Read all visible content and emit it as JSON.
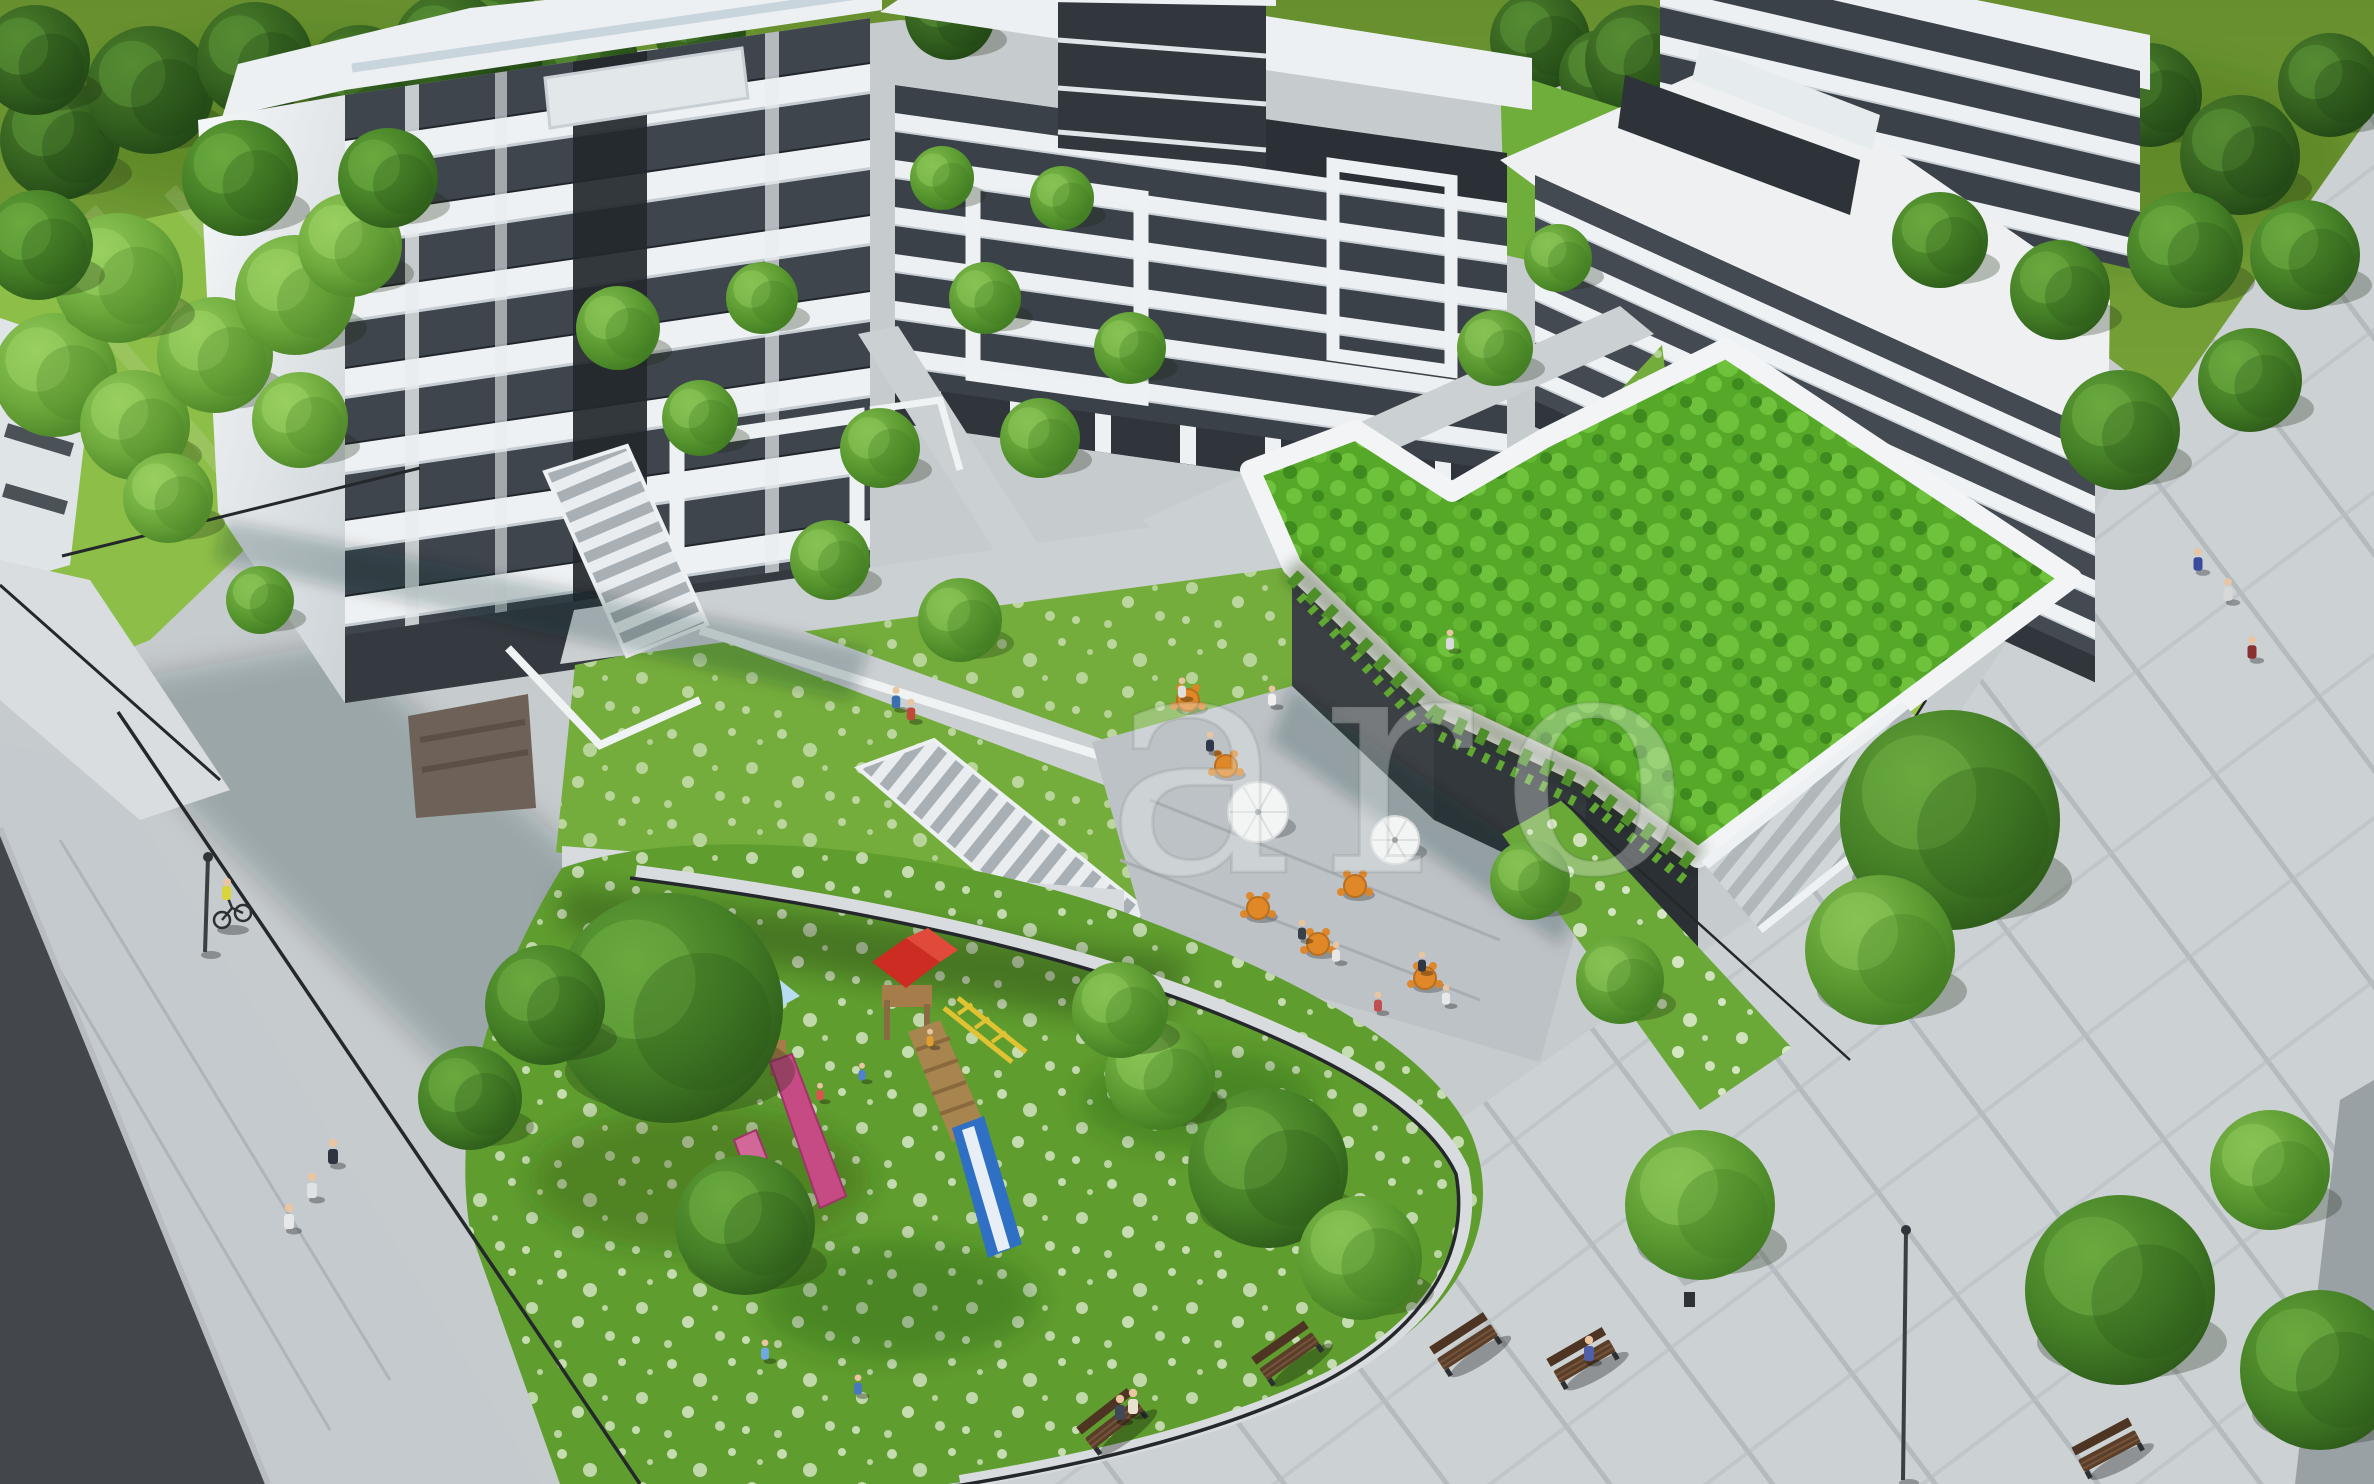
{
  "scene_type": "aerial-architectural-render",
  "watermark": {
    "text": "aro"
  },
  "palette": {
    "meadow": "#6f9b33",
    "lawn_bright": "#8cbe48",
    "courtyard_grass": "#74ad3c",
    "garden_grass": "#5f9e2e",
    "roof_garden": "#55a828",
    "flower_white": "#eef4e4",
    "pavement_light": "#ccd1d4",
    "pavement_mid": "#c4cace",
    "asphalt": "#43474c",
    "building_white": "#eef1f3",
    "glazing_dark": "#3e454d",
    "wall_charcoal": "#33383c",
    "furniture_orange": "#e08828",
    "bench_wood": "#5b3e29",
    "slide_pink": "#c64a84",
    "slide_blue": "#2f6fc4",
    "roof_red": "#cc2c22",
    "roof_light_blue": "#8fc4e6",
    "bars_yellow": "#e0c232"
  },
  "objects": {
    "trees": [
      {
        "x": 500,
        "y": 40,
        "r": 52,
        "t": "dark",
        "back": true
      },
      {
        "x": 590,
        "y": 60,
        "r": 48,
        "t": "dark",
        "back": true
      },
      {
        "x": 700,
        "y": 30,
        "r": 46,
        "t": "dark",
        "back": true
      },
      {
        "x": 950,
        "y": 15,
        "r": 45,
        "t": "dark",
        "back": true
      },
      {
        "x": 1540,
        "y": 40,
        "r": 50,
        "t": "dark",
        "back": true
      },
      {
        "x": 1605,
        "y": 75,
        "r": 46,
        "t": "dark",
        "back": true
      },
      {
        "x": 1640,
        "y": 60,
        "r": 55,
        "t": "dark",
        "back": true
      },
      {
        "x": 1730,
        "y": 110,
        "r": 50,
        "t": "dark",
        "back": true
      },
      {
        "x": 1810,
        "y": 55,
        "r": 52,
        "t": "dark",
        "back": true
      },
      {
        "x": 1900,
        "y": 130,
        "r": 55,
        "t": "dark",
        "back": true
      },
      {
        "x": 1990,
        "y": 75,
        "r": 50,
        "t": "dark",
        "back": true
      },
      {
        "x": 2070,
        "y": 160,
        "r": 55,
        "t": "dark",
        "back": true
      },
      {
        "x": 2150,
        "y": 95,
        "r": 52,
        "t": "dark",
        "back": true
      },
      {
        "x": 2240,
        "y": 155,
        "r": 60,
        "t": "dark",
        "back": true
      },
      {
        "x": 2330,
        "y": 85,
        "r": 52,
        "t": "dark",
        "back": true
      },
      {
        "x": 60,
        "y": 140,
        "r": 60,
        "t": "dark",
        "back": true
      },
      {
        "x": 150,
        "y": 90,
        "r": 64,
        "t": "dark",
        "back": true
      },
      {
        "x": 255,
        "y": 60,
        "r": 58,
        "t": "dark",
        "back": true
      },
      {
        "x": 360,
        "y": 80,
        "r": 55,
        "t": "dark",
        "back": true
      },
      {
        "x": 450,
        "y": 50,
        "r": 58,
        "t": "dark",
        "back": true
      },
      {
        "x": 35,
        "y": 60,
        "r": 55,
        "t": "dark",
        "back": true
      },
      {
        "x": 55,
        "y": 375,
        "r": 62,
        "t": "birch"
      },
      {
        "x": 135,
        "y": 425,
        "r": 55,
        "t": "birch"
      },
      {
        "x": 215,
        "y": 355,
        "r": 58,
        "t": "birch"
      },
      {
        "x": 295,
        "y": 295,
        "r": 60,
        "t": "birch"
      },
      {
        "x": 118,
        "y": 278,
        "r": 65,
        "t": "birch"
      },
      {
        "x": 38,
        "y": 245,
        "r": 55,
        "t": "mid"
      },
      {
        "x": 350,
        "y": 245,
        "r": 52,
        "t": "birch"
      },
      {
        "x": 300,
        "y": 420,
        "r": 48,
        "t": "birch"
      },
      {
        "x": 168,
        "y": 498,
        "r": 45,
        "t": "birch"
      },
      {
        "x": 388,
        "y": 178,
        "r": 50,
        "t": "mid"
      },
      {
        "x": 240,
        "y": 178,
        "r": 58,
        "t": "mid"
      },
      {
        "x": 2305,
        "y": 255,
        "r": 55,
        "t": "mid"
      },
      {
        "x": 2185,
        "y": 250,
        "r": 58,
        "t": "mid"
      },
      {
        "x": 2060,
        "y": 290,
        "r": 50,
        "t": "mid"
      },
      {
        "x": 1940,
        "y": 240,
        "r": 48,
        "t": "mid"
      },
      {
        "x": 2120,
        "y": 430,
        "r": 60,
        "t": "mid"
      },
      {
        "x": 2250,
        "y": 380,
        "r": 52,
        "t": "mid"
      },
      {
        "x": 1950,
        "y": 820,
        "r": 110,
        "t": "mid"
      },
      {
        "x": 1880,
        "y": 950,
        "r": 75,
        "t": "light"
      },
      {
        "x": 2120,
        "y": 1290,
        "r": 95,
        "t": "mid"
      },
      {
        "x": 2320,
        "y": 1370,
        "r": 80,
        "t": "mid"
      },
      {
        "x": 2270,
        "y": 1170,
        "r": 60,
        "t": "light"
      },
      {
        "x": 1700,
        "y": 1205,
        "r": 75,
        "t": "light"
      },
      {
        "x": 618,
        "y": 328,
        "r": 42,
        "t": "light"
      },
      {
        "x": 700,
        "y": 418,
        "r": 38,
        "t": "light"
      },
      {
        "x": 762,
        "y": 298,
        "r": 36,
        "t": "light"
      },
      {
        "x": 880,
        "y": 448,
        "r": 40,
        "t": "light"
      },
      {
        "x": 985,
        "y": 298,
        "r": 36,
        "t": "light"
      },
      {
        "x": 1040,
        "y": 438,
        "r": 40,
        "t": "light"
      },
      {
        "x": 1130,
        "y": 348,
        "r": 36,
        "t": "light"
      },
      {
        "x": 942,
        "y": 178,
        "r": 32,
        "t": "light"
      },
      {
        "x": 1062,
        "y": 198,
        "r": 32,
        "t": "light"
      },
      {
        "x": 1495,
        "y": 348,
        "r": 38,
        "t": "light"
      },
      {
        "x": 1558,
        "y": 258,
        "r": 34,
        "t": "light"
      },
      {
        "x": 830,
        "y": 560,
        "r": 40,
        "t": "light"
      },
      {
        "x": 960,
        "y": 620,
        "r": 42,
        "t": "light"
      },
      {
        "x": 260,
        "y": 600,
        "r": 34,
        "t": "light"
      },
      {
        "x": 668,
        "y": 1008,
        "r": 115,
        "t": "mid"
      },
      {
        "x": 745,
        "y": 1225,
        "r": 70,
        "t": "mid"
      },
      {
        "x": 545,
        "y": 1005,
        "r": 60,
        "t": "mid"
      },
      {
        "x": 470,
        "y": 1098,
        "r": 52,
        "t": "mid"
      },
      {
        "x": 1268,
        "y": 1168,
        "r": 80,
        "t": "mid"
      },
      {
        "x": 1360,
        "y": 1258,
        "r": 62,
        "t": "light"
      },
      {
        "x": 1160,
        "y": 1075,
        "r": 55,
        "t": "light"
      },
      {
        "x": 1120,
        "y": 1010,
        "r": 48,
        "t": "light"
      },
      {
        "x": 1530,
        "y": 880,
        "r": 40,
        "t": "light"
      },
      {
        "x": 1620,
        "y": 980,
        "r": 44,
        "t": "light"
      }
    ],
    "people": [
      {
        "x": 289,
        "y": 1217,
        "s": 1,
        "c": "#e8e8e8"
      },
      {
        "x": 312,
        "y": 1186,
        "s": 1,
        "c": "#dfe3e6"
      },
      {
        "x": 333,
        "y": 1152,
        "s": 1,
        "c": "#2e3340"
      },
      {
        "x": 896,
        "y": 698,
        "s": 0.85,
        "c": "#3a6fb0"
      },
      {
        "x": 911,
        "y": 710,
        "s": 0.85,
        "c": "#c04a3a"
      },
      {
        "x": 2198,
        "y": 560,
        "s": 0.9,
        "c": "#3a4a9c"
      },
      {
        "x": 2228,
        "y": 590,
        "s": 0.9,
        "c": "#d8d8d8"
      },
      {
        "x": 2252,
        "y": 648,
        "s": 0.9,
        "c": "#8a3030"
      },
      {
        "x": 1182,
        "y": 688,
        "s": 0.8,
        "c": "#e0e0e0"
      },
      {
        "x": 1210,
        "y": 742,
        "s": 0.8,
        "c": "#30384a"
      },
      {
        "x": 1272,
        "y": 696,
        "s": 0.8,
        "c": "#f0f0f0"
      },
      {
        "x": 1302,
        "y": 930,
        "s": 0.8,
        "c": "#384048"
      },
      {
        "x": 1336,
        "y": 952,
        "s": 0.8,
        "c": "#e8e8e8"
      },
      {
        "x": 1422,
        "y": 962,
        "s": 0.8,
        "c": "#303848"
      },
      {
        "x": 1446,
        "y": 995,
        "s": 0.8,
        "c": "#e8e8e8"
      },
      {
        "x": 1378,
        "y": 1002,
        "s": 0.8,
        "c": "#c05050"
      },
      {
        "x": 1120,
        "y": 1408,
        "s": 1,
        "c": "#404858"
      },
      {
        "x": 1133,
        "y": 1402,
        "s": 1,
        "c": "#e8e0d0"
      },
      {
        "x": 1589,
        "y": 1349,
        "s": 1,
        "c": "#5060a8"
      },
      {
        "x": 820,
        "y": 1092,
        "s": 0.7,
        "c": "#e05050"
      },
      {
        "x": 862,
        "y": 1072,
        "s": 0.7,
        "c": "#5080d0"
      },
      {
        "x": 930,
        "y": 1038,
        "s": 0.7,
        "c": "#e0a030"
      },
      {
        "x": 765,
        "y": 1350,
        "s": 0.8,
        "c": "#70a8e0"
      },
      {
        "x": 858,
        "y": 1385,
        "s": 0.8,
        "c": "#4878c0"
      },
      {
        "x": 1450,
        "y": 640,
        "s": 0.8,
        "c": "#d8dadc"
      }
    ],
    "cafe_tables": [
      {
        "x": 1188,
        "y": 700
      },
      {
        "x": 1226,
        "y": 766
      },
      {
        "x": 1258,
        "y": 908
      },
      {
        "x": 1318,
        "y": 944
      },
      {
        "x": 1355,
        "y": 886
      },
      {
        "x": 1425,
        "y": 978
      }
    ],
    "umbrellas": [
      {
        "x": 1258,
        "y": 812,
        "r": 30
      },
      {
        "x": 1395,
        "y": 840,
        "r": 24
      }
    ],
    "benches": [
      {
        "x": 1115,
        "y": 1425,
        "rot": -38
      },
      {
        "x": 1290,
        "y": 1357,
        "rot": -35
      },
      {
        "x": 1468,
        "y": 1348,
        "rot": -33
      },
      {
        "x": 1585,
        "y": 1362,
        "rot": -30
      },
      {
        "x": 2110,
        "y": 1452,
        "rot": -28
      }
    ],
    "lamps": [
      {
        "x": 205,
        "y": 952,
        "h": 95
      },
      {
        "x": 1903,
        "y": 1480,
        "h": 250
      }
    ]
  }
}
